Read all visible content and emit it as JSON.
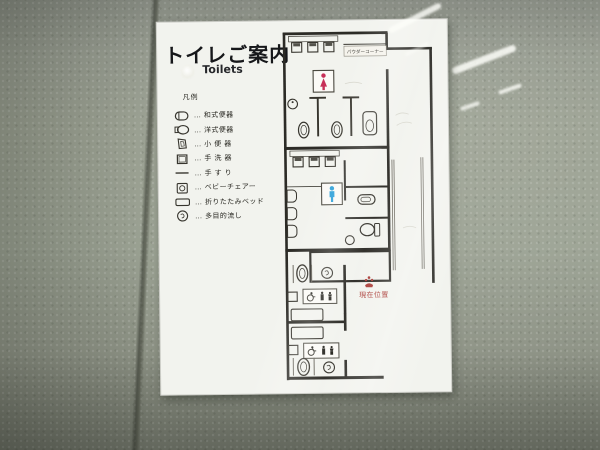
{
  "sign": {
    "title": "トイレご案内",
    "subtitle": "Toilets",
    "legend": {
      "heading": "凡例",
      "separator": "…",
      "items": [
        {
          "symbol": "squat-toilet",
          "label": "和式便器"
        },
        {
          "symbol": "western-toilet",
          "label": "洋式便器"
        },
        {
          "symbol": "urinal",
          "label": "小 便 器"
        },
        {
          "symbol": "hand-wash-basin",
          "label": "手 洗 器"
        },
        {
          "symbol": "handrail",
          "label": "手 す り"
        },
        {
          "symbol": "baby-chair",
          "label": "ベビーチェアー"
        },
        {
          "symbol": "folding-bed",
          "label": "折りたたみベッド"
        },
        {
          "symbol": "multipurpose-sink",
          "label": "多目的流し"
        }
      ]
    },
    "map": {
      "powder_corner_label": "パウダーコーナー",
      "current_location_label": "現在位置",
      "icons": {
        "womens_room": "female-pictogram",
        "mens_room": "male-pictogram",
        "accessible_rooms": "wheelchair-and-baby-pictograms",
        "current_location": "location-marker-icon"
      }
    }
  },
  "colors": {
    "wall": "#969b8d",
    "panel": "#f2f3ee",
    "plan_lines": "#2c2b26",
    "female_pictogram": "#c73058",
    "male_pictogram": "#2b9fd8",
    "current_location_red": "#a93a35",
    "tile_joint": "#4c4f46"
  }
}
